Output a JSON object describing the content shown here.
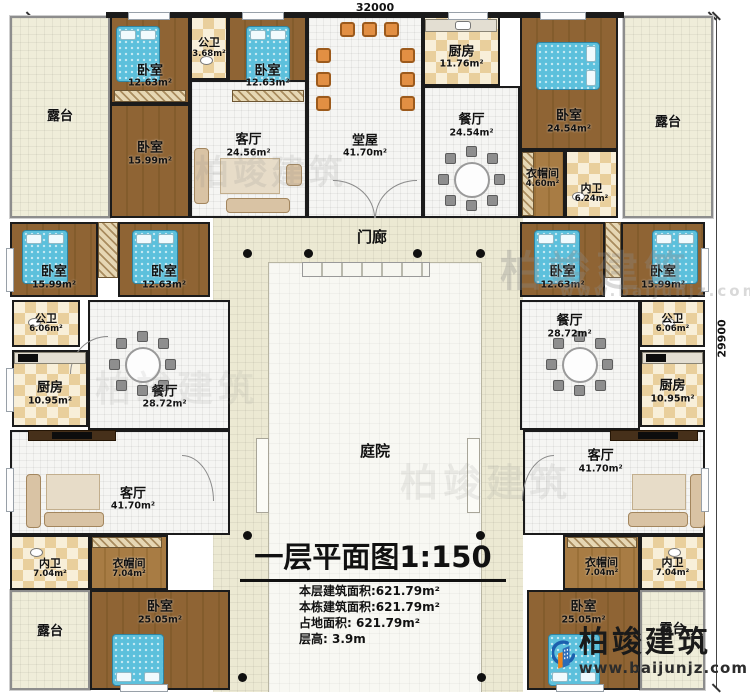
{
  "dims": {
    "top": "32000",
    "right": "29900"
  },
  "labels": {
    "courtyard": "庭院",
    "porch": "门廊"
  },
  "terraces": [
    "露台",
    "露台",
    "露台",
    "露台"
  ],
  "rooms": [
    {
      "name": "卧室",
      "area": "12.63m²"
    },
    {
      "name": "公卫",
      "area": "3.68m²"
    },
    {
      "name": "卧室",
      "area": "12.63m²"
    },
    {
      "name": "厨房",
      "area": "11.76m²"
    },
    {
      "name": "卧室",
      "area": "24.54m²"
    },
    {
      "name": "卧室",
      "area": "15.99m²"
    },
    {
      "name": "客厅",
      "area": "24.56m²"
    },
    {
      "name": "堂屋",
      "area": "41.70m²"
    },
    {
      "name": "餐厅",
      "area": "24.54m²"
    },
    {
      "name": "衣帽间",
      "area": "4.60m²"
    },
    {
      "name": "内卫",
      "area": "6.24m²"
    },
    {
      "name": "卧室",
      "area": "15.99m²"
    },
    {
      "name": "卧室",
      "area": "12.63m²"
    },
    {
      "name": "公卫",
      "area": "6.06m²"
    },
    {
      "name": "厨房",
      "area": "10.95m²"
    },
    {
      "name": "餐厅",
      "area": "28.72m²"
    },
    {
      "name": "卧室",
      "area": "12.63m²"
    },
    {
      "name": "卧室",
      "area": "15.99m²"
    },
    {
      "name": "餐厅",
      "area": "28.72m²"
    },
    {
      "name": "公卫",
      "area": "6.06m²"
    },
    {
      "name": "厨房",
      "area": "10.95m²"
    },
    {
      "name": "客厅",
      "area": "41.70m²"
    },
    {
      "name": "内卫",
      "area": "7.04m²"
    },
    {
      "name": "衣帽间",
      "area": "7.04m²"
    },
    {
      "name": "卧室",
      "area": "25.05m²"
    },
    {
      "name": "客厅",
      "area": "41.70m²"
    },
    {
      "name": "衣帽间",
      "area": "7.04m²"
    },
    {
      "name": "内卫",
      "area": "7.04m²"
    },
    {
      "name": "卧室",
      "area": "25.05m²"
    }
  ],
  "title_block": {
    "title": "一层平面图1:150",
    "info": [
      "本层建筑面积:621.79m²",
      "本栋建筑面积:621.79m²",
      "占地面积: 621.79m²",
      "层高: 3.9m"
    ]
  },
  "watermark": {
    "brand": "柏竣建筑",
    "site": "www.baijunjz.com"
  },
  "logo": {
    "brand": "柏竣建筑",
    "site": "www.baijunjz.com"
  },
  "icons": {
    "column": "column-dot",
    "logo": "baijun-building-logo",
    "bed": "bed-icon",
    "sofa": "sofa-icon",
    "dining_table": "dining-table-icon"
  },
  "colors": {
    "wood": "#8f6434",
    "checker_dark": "#e9cf9c",
    "checker_light": "#f8efd9",
    "terrace": "#efedd9",
    "bed": "#5cc0dc",
    "logo_blue": "#1c5fae",
    "logo_orange": "#e8821e"
  }
}
